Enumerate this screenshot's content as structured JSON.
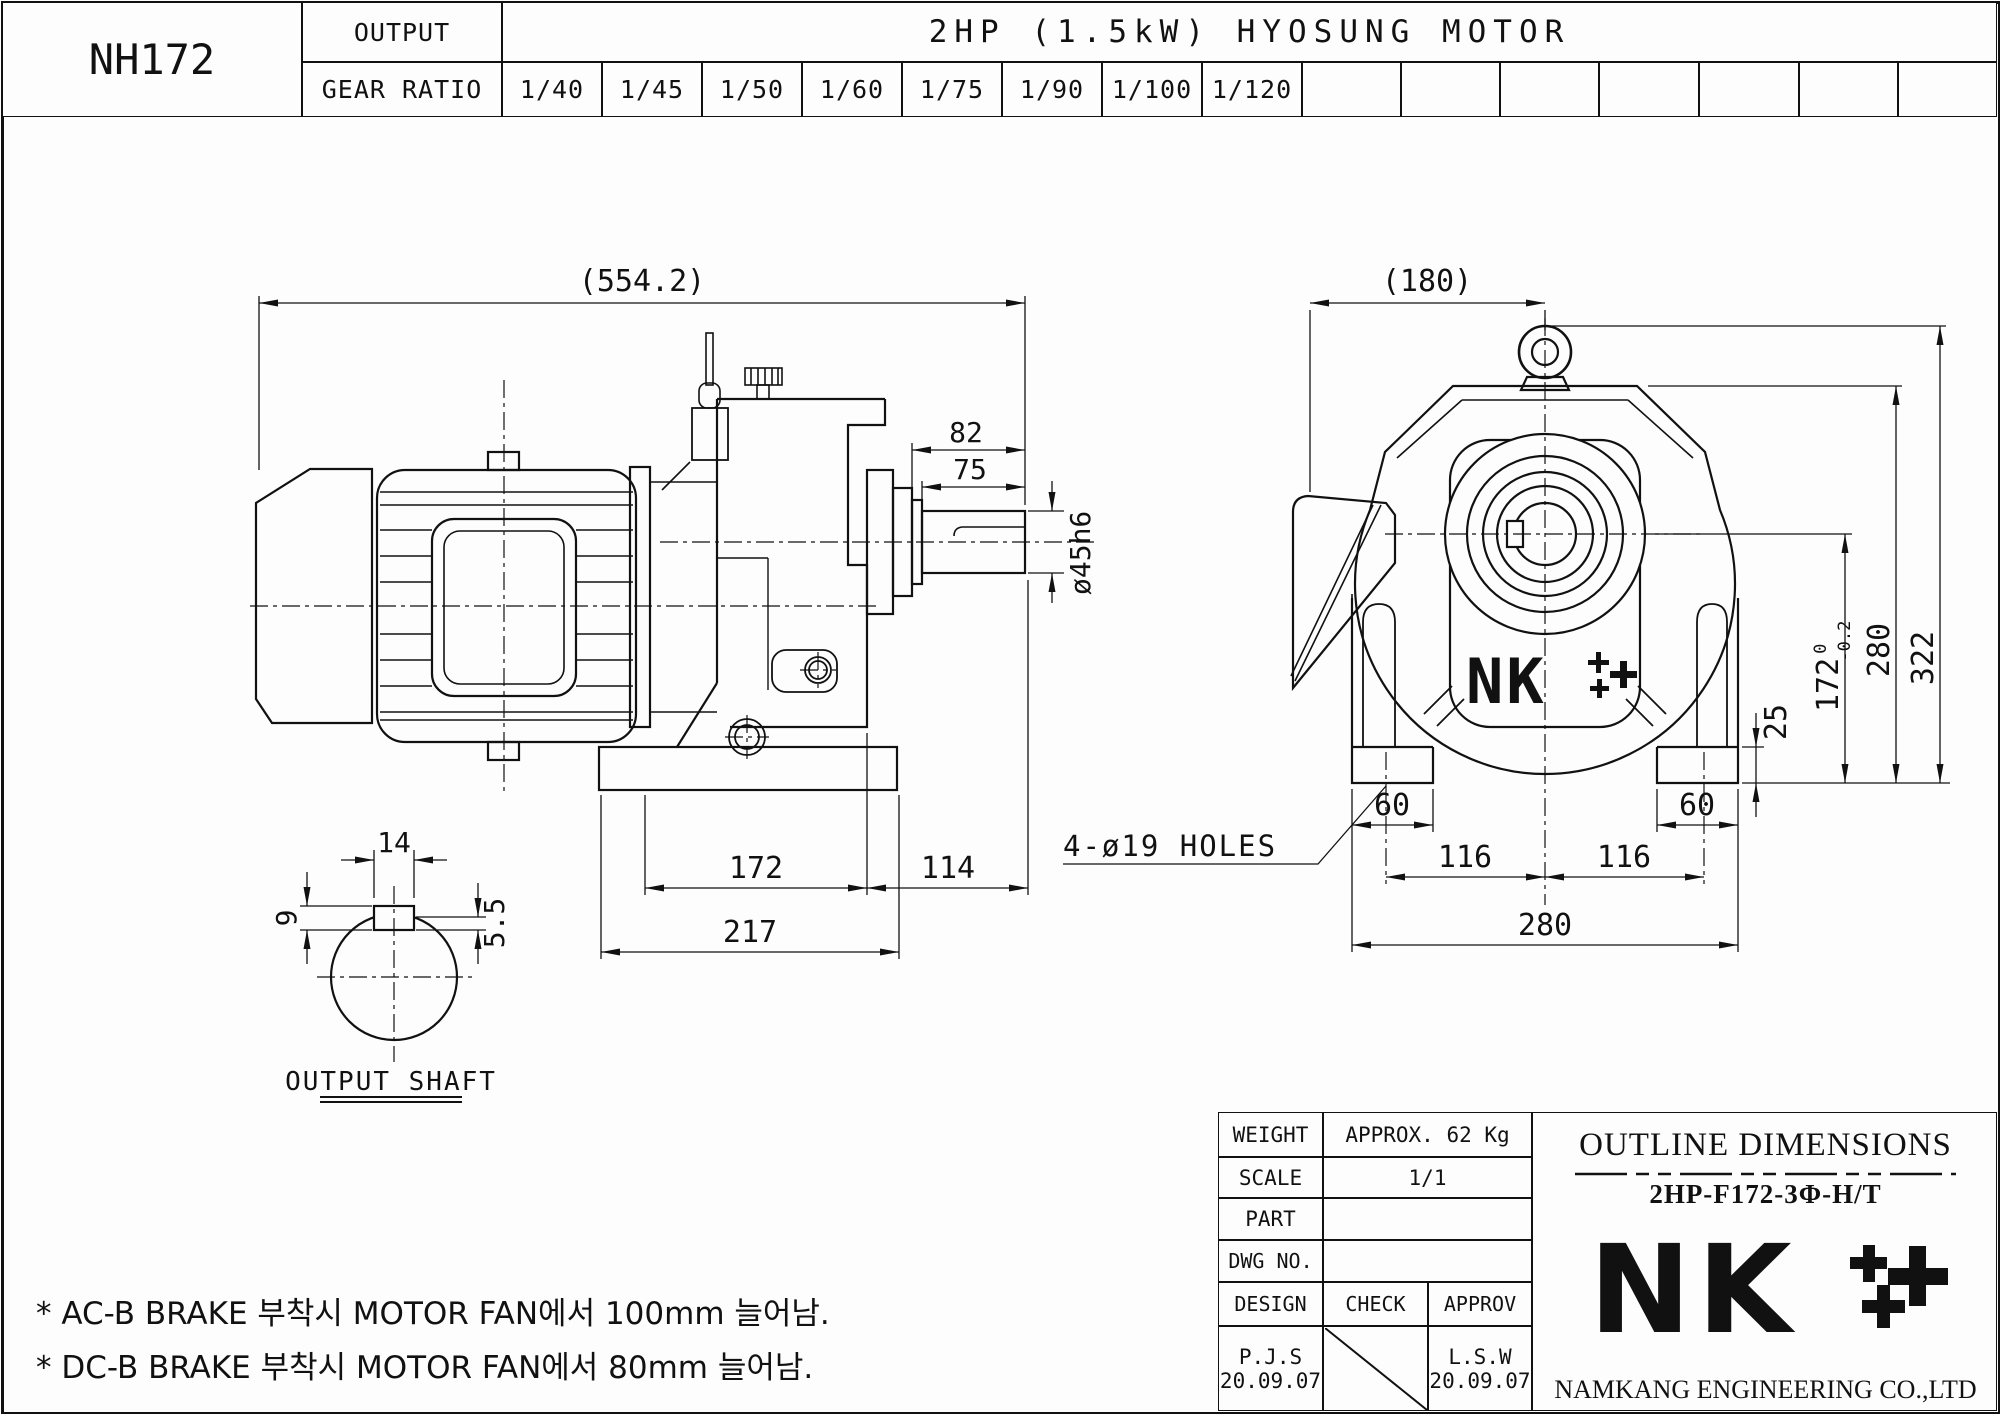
{
  "header": {
    "model": "NH172",
    "output_label": "OUTPUT",
    "gear_ratio_label": "GEAR RATIO",
    "motor_title": "2HP (1.5kW) HYOSUNG MOTOR",
    "gear_ratios": [
      "1/40",
      "1/45",
      "1/50",
      "1/60",
      "1/75",
      "1/90",
      "1/100",
      "1/120"
    ]
  },
  "side_view": {
    "dim_overall": "(554.2)",
    "dim_shaft_total": "82",
    "dim_shaft_len": "75",
    "dim_shaft_dia": "ø45h6",
    "dim_gearbox": "172",
    "dim_shaft_overhang": "114",
    "dim_base": "217"
  },
  "shaft_detail": {
    "dim_key_width": "14",
    "dim_key_depth": "9",
    "dim_key_height": "5.5",
    "label": "OUTPUT SHAFT"
  },
  "front_view": {
    "dim_overall_width": "(180)",
    "holes_note": "4-ø19 HOLES",
    "dim_foot_left": "60",
    "dim_foot_right": "60",
    "dim_hole_left": "116",
    "dim_hole_right": "116",
    "dim_base_width": "280",
    "dim_foot_height": "25",
    "dim_shaft_height": "172",
    "dim_shaft_height_tol_upper": "0",
    "dim_shaft_height_tol_lower": "-0.2",
    "dim_body_height": "280",
    "dim_total_height": "322",
    "logo": "NK"
  },
  "notes": {
    "line1": "* AC-B BRAKE 부착시 MOTOR FAN에서 100mm 늘어남.",
    "line2": "* DC-B BRAKE 부착시 MOTOR FAN에서 80mm 늘어남."
  },
  "title_block": {
    "weight_label": "WEIGHT",
    "weight_value": "APPROX. 62 Kg",
    "scale_label": "SCALE",
    "scale_value": "1/1",
    "part_label": "PART",
    "part_value": "",
    "dwg_label": "DWG NO.",
    "dwg_value": "",
    "design_label": "DESIGN",
    "check_label": "CHECK",
    "approv_label": "APPROV",
    "design_name": "P.J.S",
    "design_date": "20.09.07",
    "approv_name": "L.S.W",
    "approv_date": "20.09.07",
    "outline_title": "OUTLINE DIMENSIONS",
    "drawing_code": "2HP-F172-3Φ-H/T",
    "logo": "NK",
    "company": "NAMKANG ENGINEERING CO.,LTD"
  }
}
